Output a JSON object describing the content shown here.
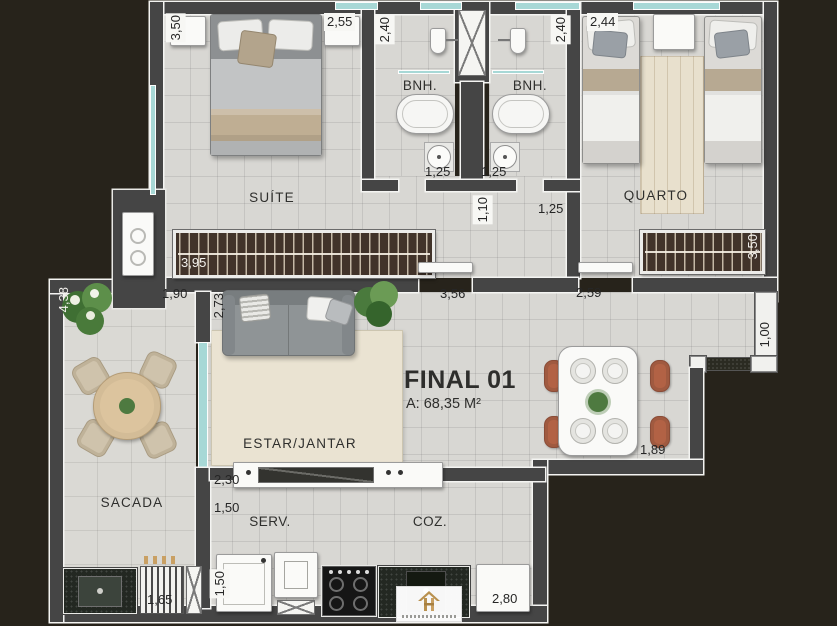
{
  "plan": {
    "unit": {
      "label": "FINAL 01",
      "area": "A: 68,35 M²"
    },
    "rooms": {
      "suite": "SUÍTE",
      "bnh1": "BNH.",
      "bnh2": "BNH.",
      "quarto": "QUARTO",
      "living": "ESTAR/JANTAR",
      "sacada": "SACADA",
      "service": "SERV.",
      "kitchen": "COZ."
    },
    "dimensions": {
      "suite_depth": "3,50",
      "suite_width": "2,55",
      "bnh1_depth": "2,40",
      "bnh2_depth": "2,40",
      "quarto_width": "2,44",
      "bnh1_door": "1,25",
      "bnh2_door": "1,25",
      "hall_width": "1,10",
      "hall_door": "1,25",
      "suite_closet": "3,95",
      "quarto_closet": "3,50",
      "hall_len": "1,90",
      "living_depth": "2,73",
      "living_width": "3,56",
      "dining_width": "2,59",
      "entry_wall": "1,00",
      "sacada_depth": "4,38",
      "dining_side": "1,89",
      "counter_len": "2,30",
      "service_len": "1,50",
      "service_width": "1,50",
      "grill_width": "1,65",
      "kitchen_width": "2,80"
    },
    "colors": {
      "background": "#27231b",
      "wall": "#454545",
      "wall_outline": "#f4f4f2",
      "floor": "#d8d7d3",
      "rug": "#eae3d2",
      "window_glass": "#a7d8d6",
      "closet_wood": "#41332a",
      "chair_terracotta": "#b26245",
      "balcony_table_wood": "#dcc49e",
      "logo_gold": "#b9914f"
    }
  }
}
